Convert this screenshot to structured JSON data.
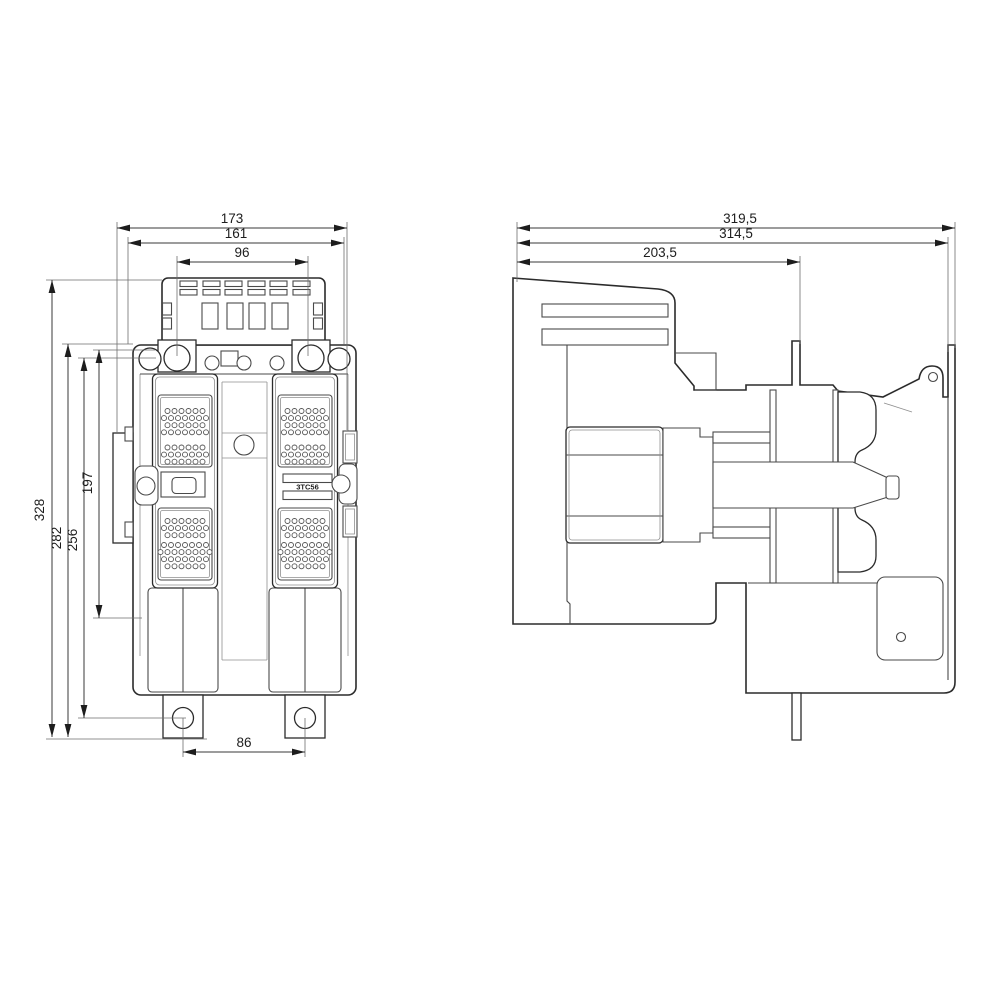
{
  "product": {
    "model_label": "3TC56"
  },
  "front_view": {
    "dims": {
      "total_width": "173",
      "body_width": "161",
      "coil_terminal_spacing": "96",
      "total_height": "328",
      "body_height": "282",
      "mounting_height": "256",
      "cover_height": "197",
      "foot_hole_spacing": "86"
    }
  },
  "side_view": {
    "dims": {
      "total_depth": "319,5",
      "plate_depth": "314,5",
      "front_depth": "203,5"
    }
  },
  "vents": {
    "dot_radius": 2.5,
    "dx": 7,
    "dy": 7.1,
    "boxes": [
      {
        "cx": 185,
        "clusters": [
          {
            "y0": 411,
            "rows": [
              6,
              7,
              6,
              7
            ]
          },
          {
            "y0": 447.5,
            "rows": [
              6,
              7,
              6
            ]
          }
        ]
      },
      {
        "cx": 185,
        "clusters": [
          {
            "y0": 521,
            "rows": [
              6,
              7,
              6
            ]
          },
          {
            "y0": 545,
            "rows": [
              7,
              8,
              7,
              6
            ]
          }
        ]
      },
      {
        "cx": 305,
        "clusters": [
          {
            "y0": 411,
            "rows": [
              6,
              7,
              6,
              7
            ]
          },
          {
            "y0": 447.5,
            "rows": [
              6,
              7,
              6
            ]
          }
        ]
      },
      {
        "cx": 305,
        "clusters": [
          {
            "y0": 521,
            "rows": [
              6,
              7,
              6
            ]
          },
          {
            "y0": 545,
            "rows": [
              7,
              8,
              7,
              6
            ]
          }
        ]
      }
    ]
  }
}
